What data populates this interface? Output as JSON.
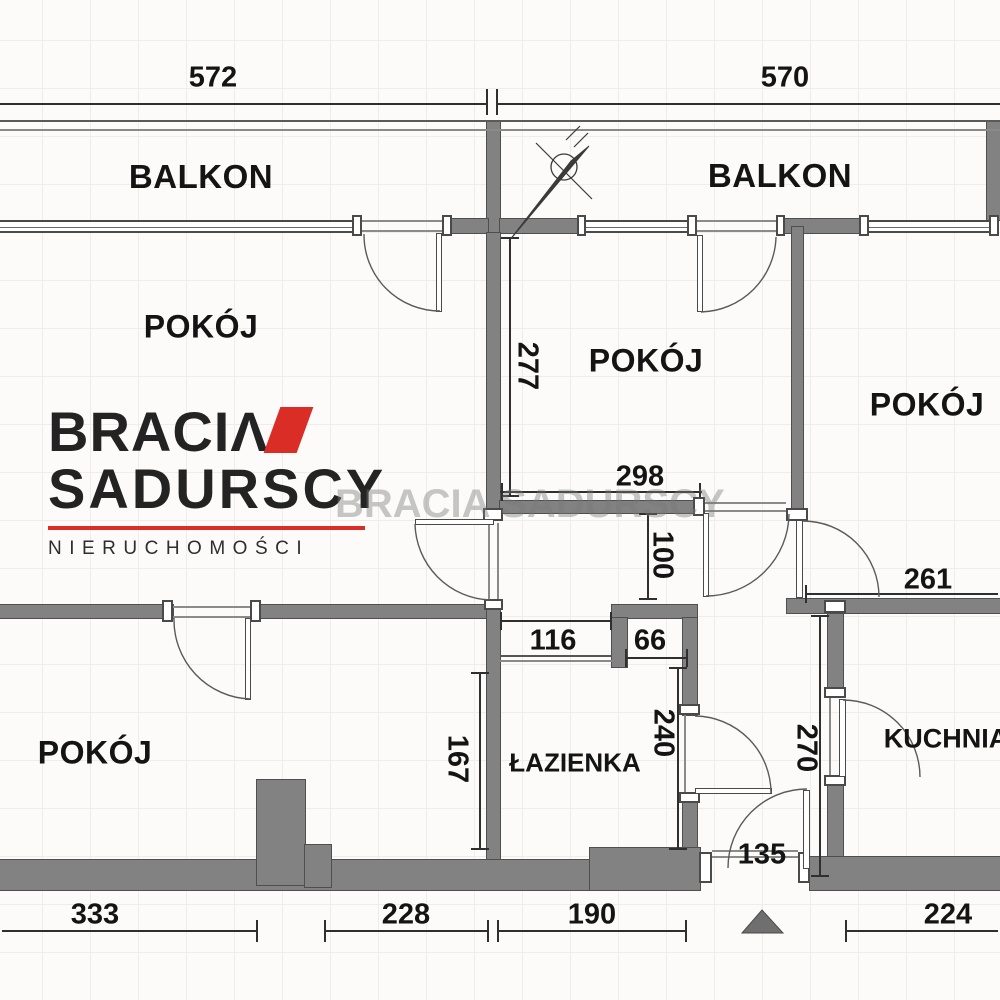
{
  "rooms": {
    "balkon_left": "BALKON",
    "balkon_right": "BALKON",
    "pokoj_top_left": "POKÓJ",
    "pokoj_middle": "POKÓJ",
    "pokoj_right": "POKÓJ",
    "pokoj_bottom_left": "POKÓJ",
    "lazienka": "ŁAZIENKA",
    "kuchnia": "KUCHNIA"
  },
  "dimensions": {
    "d572": "572",
    "d570": "570",
    "d277": "277",
    "d298": "298",
    "d100": "100",
    "d116": "116",
    "d66": "66",
    "d261": "261",
    "d167": "167",
    "d240": "240",
    "d270": "270",
    "d135": "135",
    "d333": "333",
    "d228": "228",
    "d190": "190",
    "d224": "224"
  },
  "logo": {
    "line1": "BRACIΛ",
    "line2": "SADURSCY",
    "line3": "NIERUCHOMOŚCI"
  },
  "watermark": "BRACIA SADURSCY",
  "icons": {
    "north_arrow": "north-arrow",
    "entrance_marker": "entrance-triangle"
  },
  "colors": {
    "wall": "#828282",
    "accent_red": "#d92d26",
    "line": "#4a4a4a",
    "text": "#141414"
  }
}
